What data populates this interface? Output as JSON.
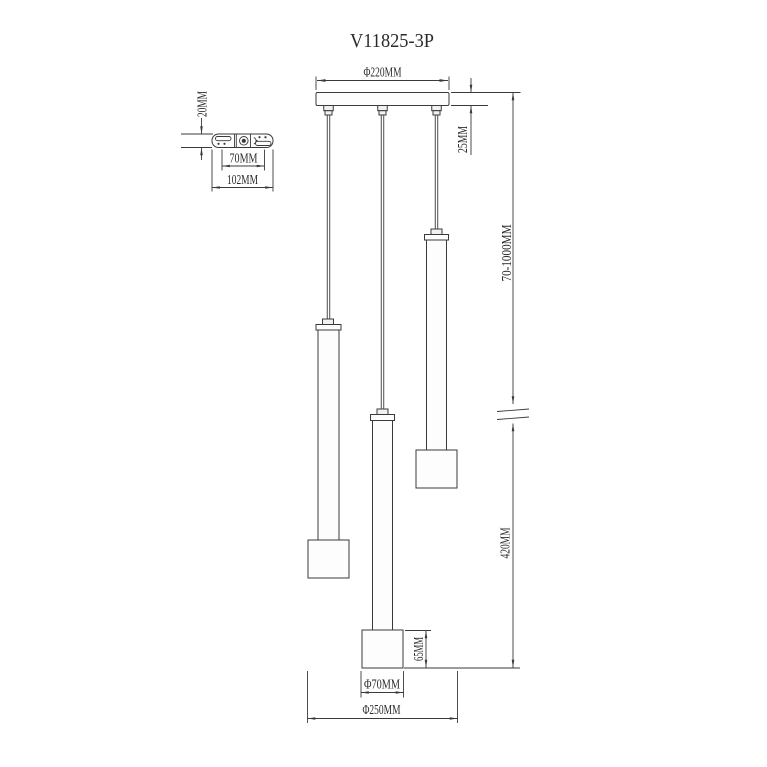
{
  "colors": {
    "background": "#ffffff",
    "line": "#3a3a3a",
    "text": "#2b2b2b"
  },
  "title": "V11825-3P",
  "dimensions": {
    "canopy_width": "Φ220MM",
    "bracket_height": "20MM",
    "bracket_hole_spacing": "70MM",
    "bracket_length": "102MM",
    "canopy_thickness": "25MM",
    "suspension_range": "70-1000MM",
    "lower_section_height": "420MM",
    "shade_height": "65MM",
    "shade_diameter": "Φ70MM",
    "overall_diameter": "Φ250MM"
  }
}
